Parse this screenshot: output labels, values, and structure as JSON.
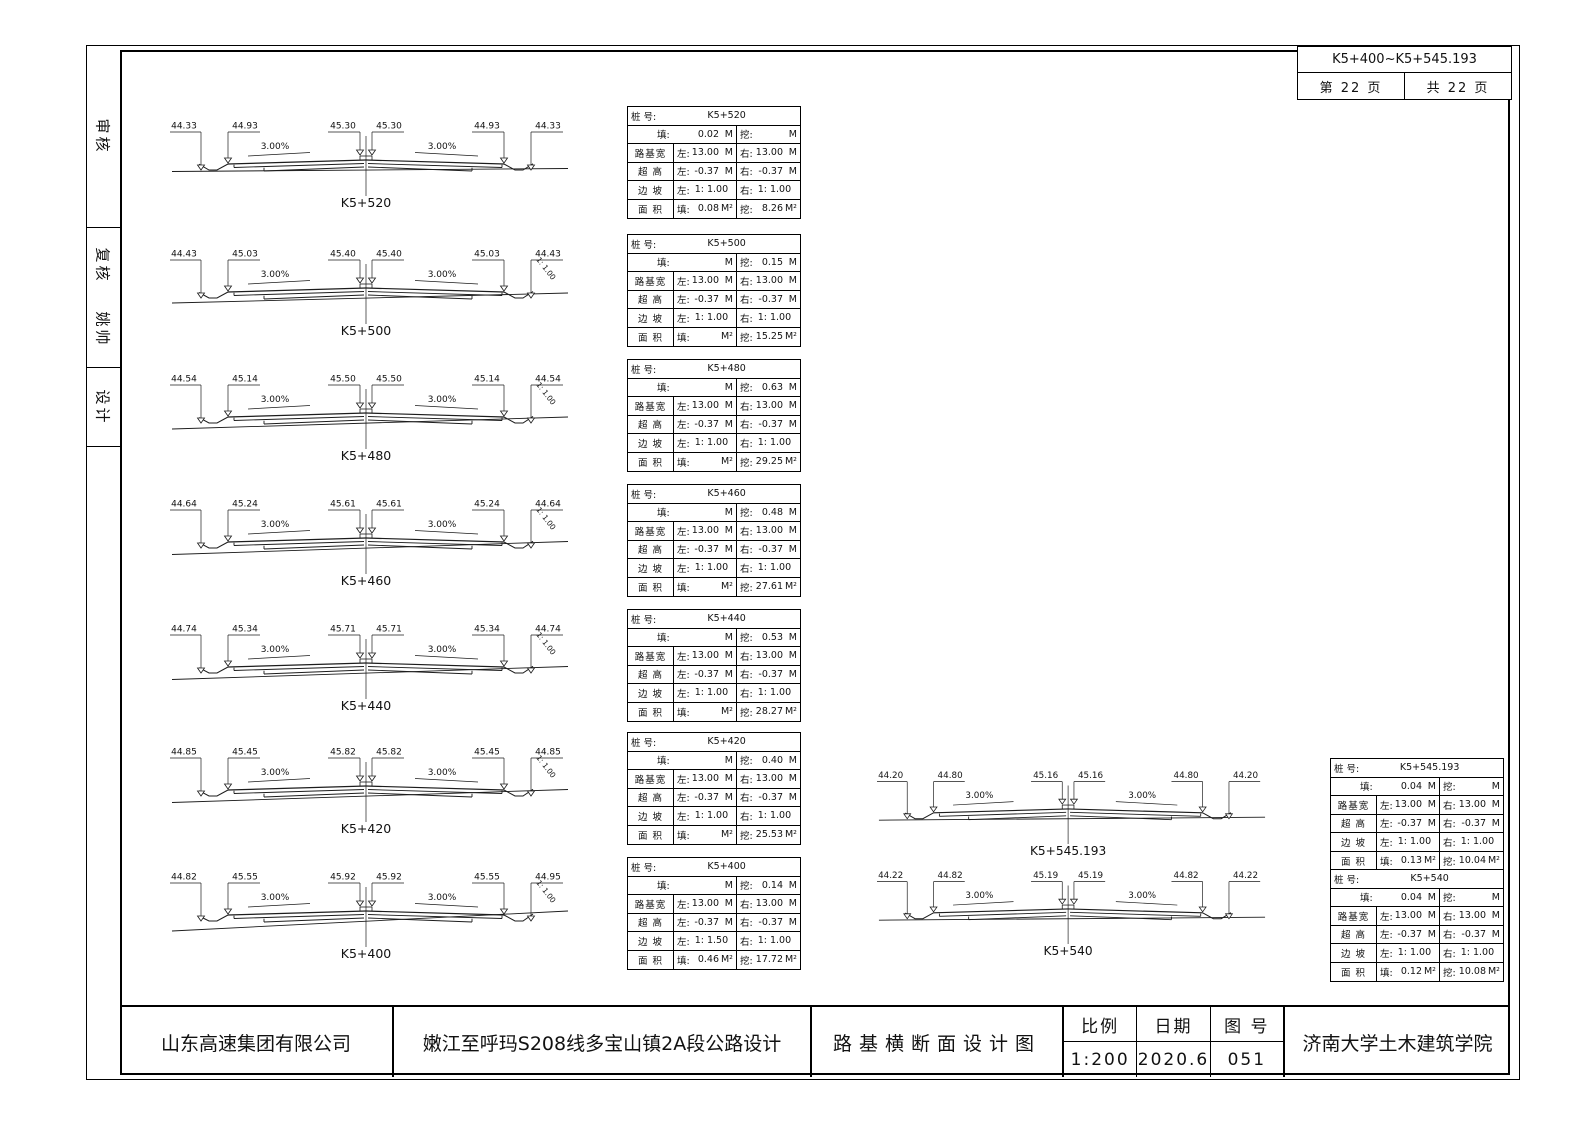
{
  "stamp": {
    "range": "K5+400~K5+545.193",
    "page": "第 22 页",
    "total": "共 22 页"
  },
  "sidebar": {
    "review": "审核",
    "recheck": "复核",
    "recheck_name": "姚帅",
    "design": "设计"
  },
  "table_labels": {
    "station_label": "桩 号:",
    "fill": "填:",
    "cut": "挖:",
    "width": "路基宽",
    "superelev": "超 高",
    "slope": "边 坡",
    "area": "面 积",
    "left": "左:",
    "right": "右:",
    "m": "M",
    "m2": "M²"
  },
  "sections": [
    {
      "station": "K5+520",
      "elevations": [
        "44.33",
        "44.93",
        "45.30",
        "45.30",
        "44.93",
        "44.33"
      ],
      "slope_left": "3.00%",
      "slope_right": "3.00%",
      "cut_slope_label": "",
      "ground_tilt": 3,
      "table": {
        "fill": "0.02",
        "cut": "",
        "width_l": "13.00",
        "width_r": "13.00",
        "se_l": "-0.37",
        "se_r": "-0.37",
        "slope_l": "1: 1.00",
        "slope_r": "1: 1.00",
        "area_fill": "0.08",
        "area_cut": "8.26"
      }
    },
    {
      "station": "K5+500",
      "elevations": [
        "44.43",
        "45.03",
        "45.40",
        "45.40",
        "45.03",
        "44.43"
      ],
      "slope_left": "3.00%",
      "slope_right": "3.00%",
      "cut_slope_label": "1: 1.00",
      "ground_tilt": 10,
      "table": {
        "fill": "",
        "cut": "0.15",
        "width_l": "13.00",
        "width_r": "13.00",
        "se_l": "-0.37",
        "se_r": "-0.37",
        "slope_l": "1: 1.00",
        "slope_r": "1: 1.00",
        "area_fill": "",
        "area_cut": "15.25"
      }
    },
    {
      "station": "K5+480",
      "elevations": [
        "44.54",
        "45.14",
        "45.50",
        "45.50",
        "45.14",
        "44.54"
      ],
      "slope_left": "3.00%",
      "slope_right": "3.00%",
      "cut_slope_label": "1: 1.00",
      "ground_tilt": 12,
      "table": {
        "fill": "",
        "cut": "0.63",
        "width_l": "13.00",
        "width_r": "13.00",
        "se_l": "-0.37",
        "se_r": "-0.37",
        "slope_l": "1: 1.00",
        "slope_r": "1: 1.00",
        "area_fill": "",
        "area_cut": "29.25"
      }
    },
    {
      "station": "K5+460",
      "elevations": [
        "44.64",
        "45.24",
        "45.61",
        "45.61",
        "45.24",
        "44.64"
      ],
      "slope_left": "3.00%",
      "slope_right": "3.00%",
      "cut_slope_label": "1: 1.00",
      "ground_tilt": 13,
      "table": {
        "fill": "",
        "cut": "0.48",
        "width_l": "13.00",
        "width_r": "13.00",
        "se_l": "-0.37",
        "se_r": "-0.37",
        "slope_l": "1: 1.00",
        "slope_r": "1: 1.00",
        "area_fill": "",
        "area_cut": "27.61"
      }
    },
    {
      "station": "K5+440",
      "elevations": [
        "44.74",
        "45.34",
        "45.71",
        "45.71",
        "45.34",
        "44.74"
      ],
      "slope_left": "3.00%",
      "slope_right": "3.00%",
      "cut_slope_label": "1: 1.00",
      "ground_tilt": 13,
      "table": {
        "fill": "",
        "cut": "0.53",
        "width_l": "13.00",
        "width_r": "13.00",
        "se_l": "-0.37",
        "se_r": "-0.37",
        "slope_l": "1: 1.00",
        "slope_r": "1: 1.00",
        "area_fill": "",
        "area_cut": "28.27"
      }
    },
    {
      "station": "K5+420",
      "elevations": [
        "44.85",
        "45.45",
        "45.82",
        "45.82",
        "45.45",
        "44.85"
      ],
      "slope_left": "3.00%",
      "slope_right": "3.00%",
      "cut_slope_label": "1: 1.00",
      "ground_tilt": 13,
      "table": {
        "fill": "",
        "cut": "0.40",
        "width_l": "13.00",
        "width_r": "13.00",
        "se_l": "-0.37",
        "se_r": "-0.37",
        "slope_l": "1: 1.00",
        "slope_r": "1: 1.00",
        "area_fill": "",
        "area_cut": "25.53"
      }
    },
    {
      "station": "K5+400",
      "elevations": [
        "44.82",
        "45.55",
        "45.92",
        "45.92",
        "45.55",
        "44.95"
      ],
      "slope_left": "3.00%",
      "slope_right": "3.00%",
      "cut_slope_label": "1: 1.00",
      "ground_tilt": 20,
      "table": {
        "fill": "",
        "cut": "0.14",
        "width_l": "13.00",
        "width_r": "13.00",
        "se_l": "-0.37",
        "se_r": "-0.37",
        "slope_l": "1: 1.50",
        "slope_r": "1: 1.00",
        "area_fill": "0.46",
        "area_cut": "17.72"
      }
    },
    {
      "station": "K5+545.193",
      "elevations": [
        "44.20",
        "44.80",
        "45.16",
        "45.16",
        "44.80",
        "44.20"
      ],
      "slope_left": "3.00%",
      "slope_right": "3.00%",
      "cut_slope_label": "",
      "ground_tilt": 3,
      "table": {
        "fill": "0.04",
        "cut": "",
        "width_l": "13.00",
        "width_r": "13.00",
        "se_l": "-0.37",
        "se_r": "-0.37",
        "slope_l": "1: 1.00",
        "slope_r": "1: 1.00",
        "area_fill": "0.13",
        "area_cut": "10.04"
      }
    },
    {
      "station": "K5+540",
      "elevations": [
        "44.22",
        "44.82",
        "45.19",
        "45.19",
        "44.82",
        "44.22"
      ],
      "slope_left": "3.00%",
      "slope_right": "3.00%",
      "cut_slope_label": "",
      "ground_tilt": 3,
      "table": {
        "fill": "0.04",
        "cut": "",
        "width_l": "13.00",
        "width_r": "13.00",
        "se_l": "-0.37",
        "se_r": "-0.37",
        "slope_l": "1: 1.00",
        "slope_r": "1: 1.00",
        "area_fill": "0.12",
        "area_cut": "10.08"
      }
    }
  ],
  "titlebar": {
    "company": "山东高速集团有限公司",
    "project": "嫩江至呼玛S208线多宝山镇2A段公路设计",
    "drawing": "路基横断面设计图",
    "scale_label": "比例",
    "scale": "1:200",
    "date_label": "日期",
    "date": "2020.6",
    "no_label": "图 号",
    "no": "051",
    "institute": "济南大学土木建筑学院"
  }
}
